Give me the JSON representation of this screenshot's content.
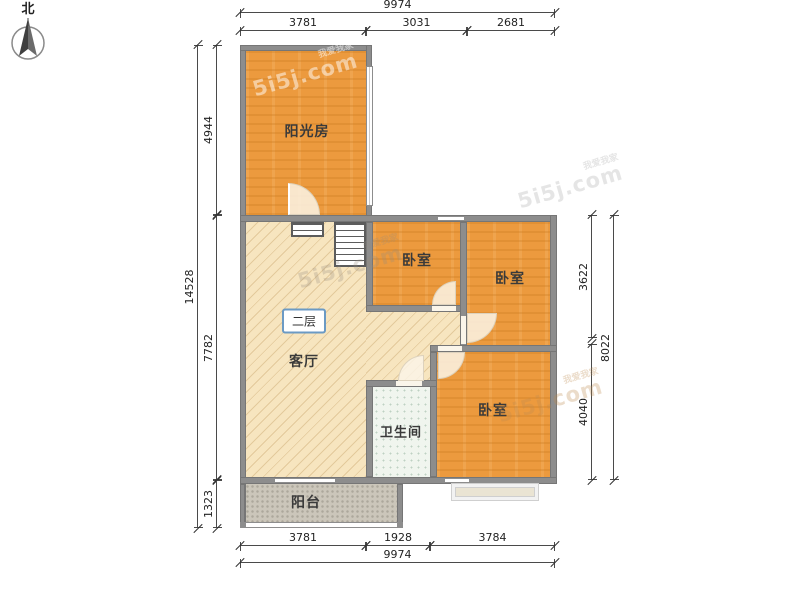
{
  "north": {
    "label": "北"
  },
  "watermark": {
    "brand": "5i5j.com",
    "company": "我爱我家"
  },
  "floor_badge": "二层",
  "rooms": {
    "sunroom": "阳光房",
    "bedroom1": "卧室",
    "bedroom2": "卧室",
    "bedroom3": "卧室",
    "living": "客厅",
    "bathroom": "卫生间",
    "balcony": "阳台"
  },
  "dimensions": {
    "top": {
      "total": "9974",
      "segments": [
        "3781",
        "3031",
        "2681"
      ]
    },
    "bottom": {
      "total": "9974",
      "segments": [
        "3781",
        "1928",
        "3784"
      ]
    },
    "left": {
      "total": "14528",
      "segments": [
        "4944",
        "7782",
        "1323"
      ]
    },
    "right": {
      "total": "8022",
      "segments": [
        "3622",
        "4040"
      ]
    }
  },
  "colors": {
    "room_orange": "#EC9A3E",
    "living_beige": "#F7E5BF",
    "bathroom_tile": "#F0F5EE",
    "balcony_stone": "#CBC6BA",
    "wall_gray": "#8D8D8D",
    "badge_border": "#6B9AC4",
    "dim_text": "#222222"
  }
}
